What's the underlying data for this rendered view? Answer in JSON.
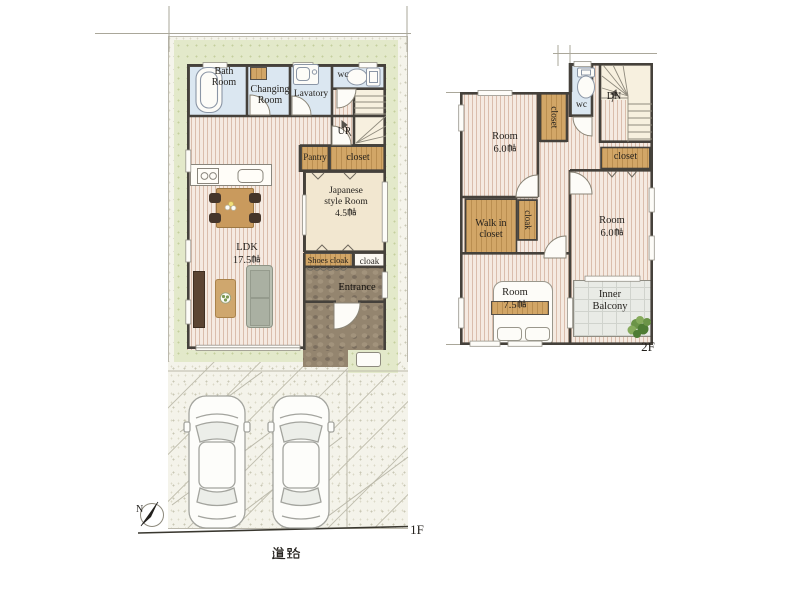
{
  "palette": {
    "wall": "#45413b",
    "wet_room_blue": "#dbe7f1",
    "wood_floor": "#f5eae1",
    "wood_fixture_tan": "#d2a667",
    "tatami_cream": "#f2e7d0",
    "yard_green": "#e3e9ca",
    "entrance_stone": "#94856f",
    "balcony_gray": "#e9ebe6",
    "stair_cream": "#f7f0df",
    "site_speckle": "#f5f4eb"
  },
  "floor1": {
    "floor_label": "1F",
    "road_label": "道路",
    "compass_label": "N",
    "bath": "Bath Room",
    "changing": "Changing Room",
    "lavatory": "Lavatory",
    "wc": "wc",
    "stairs": "UP",
    "pantry": "Pantry",
    "closet": "closet",
    "japanese_room": {
      "name": "Japanese style Room",
      "size_value": "4.5",
      "size_unit": "帖"
    },
    "ldk": {
      "name": "LDK",
      "size_value": "17.5",
      "size_unit": "帖"
    },
    "shoes_cloak": "Shoes cloak",
    "cloak": "cloak",
    "entrance": "Entrance"
  },
  "floor2": {
    "floor_label": "2F",
    "room_nw": {
      "name": "Room",
      "size_value": "6.0",
      "size_unit": "帖"
    },
    "closet_nw": "closet",
    "wc": "wc",
    "stairs": "DN",
    "closet_e": "closet",
    "room_e": {
      "name": "Room",
      "size_value": "6.0",
      "size_unit": "帖"
    },
    "walk_in_closet": "Walk in closet",
    "cloak": "cloak",
    "room_sw": {
      "name": "Room",
      "size_value": "7.5",
      "size_unit": "帖"
    },
    "inner_balcony": "Inner Balcony"
  }
}
